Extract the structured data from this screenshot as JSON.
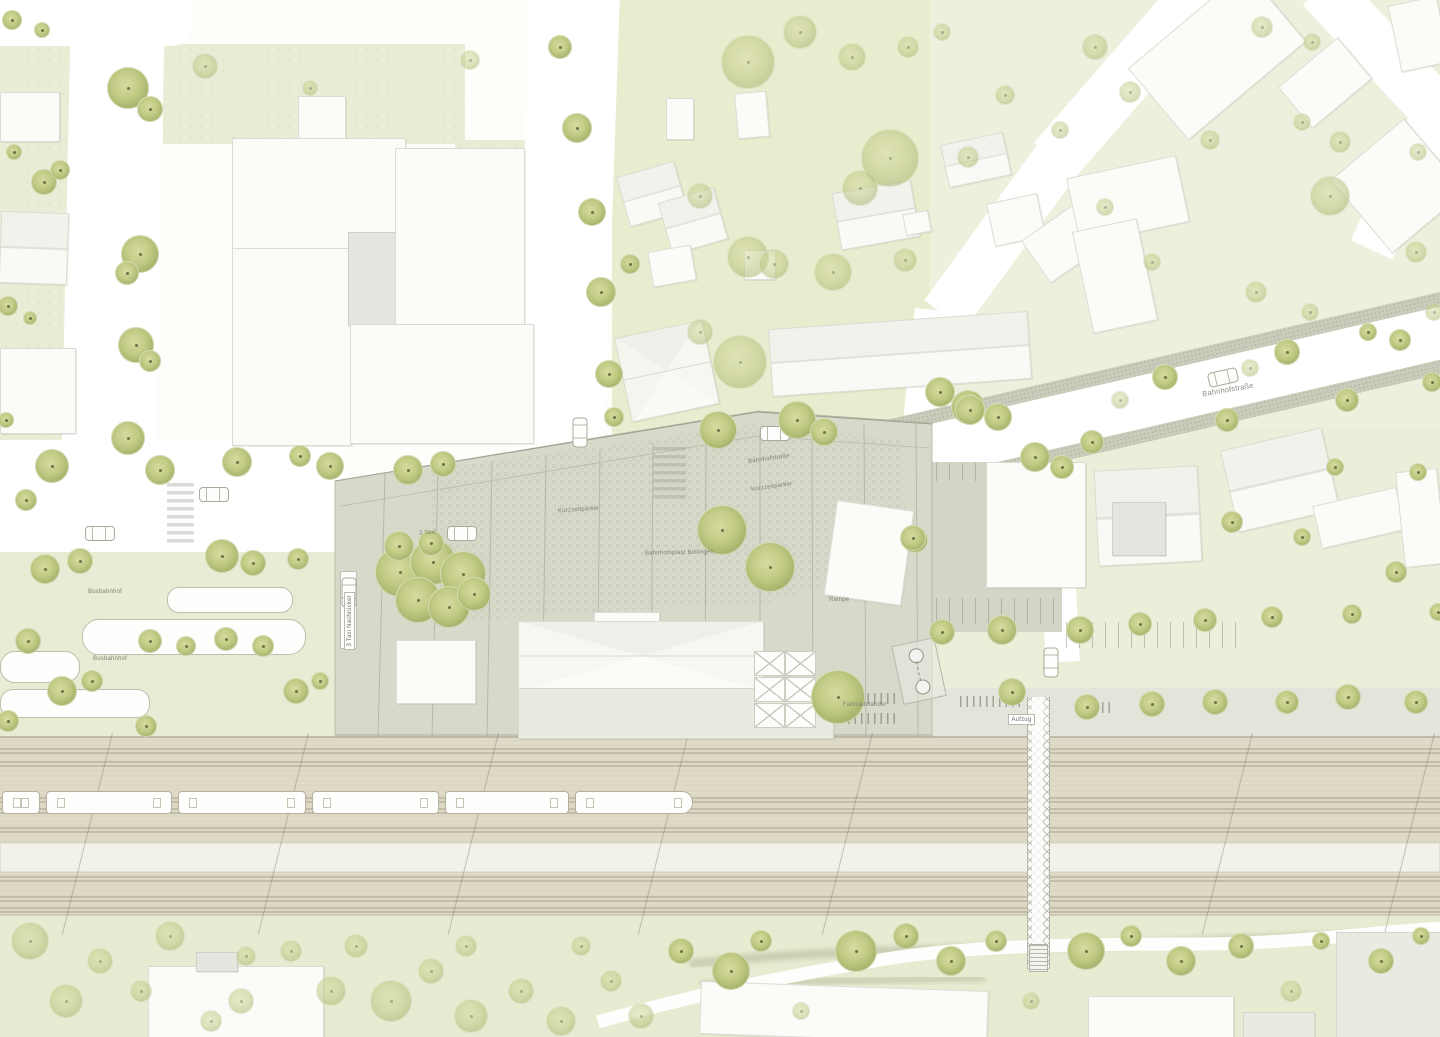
{
  "palette": {
    "road_white": "#ffffff",
    "lawn_green": "#e9edd6",
    "lawn_yellow_green": "#e9ecce",
    "plaza_gray": "#d7d9cb",
    "sidewalk_gray": "#c9ccba",
    "railbed_beige": "#dcd8c3",
    "platform_white": "#f2f2ea",
    "tree_green": "#b5c178",
    "tree_dot": "#4f5c33",
    "building_white": "#fbfbf8",
    "building_outline": "#dcdcd4",
    "label_gray": "#7f8076"
  },
  "labels": [
    {
      "t": "Busbahnhof",
      "x": 88,
      "y": 589
    },
    {
      "t": "Busbahnhof",
      "x": 93,
      "y": 656
    },
    {
      "t": "2 Taxi",
      "x": 419,
      "y": 530,
      "r": -3
    },
    {
      "t": "3 Taxi Nachrücker",
      "x": 344,
      "y": 650,
      "v": 1,
      "box": 1
    },
    {
      "t": "Kurzzeitparker",
      "x": 558,
      "y": 507,
      "r": -4
    },
    {
      "t": "Bahnhofsplatz Bellingen",
      "x": 645,
      "y": 550,
      "r": -1
    },
    {
      "t": "Bahnhofstraße",
      "x": 748,
      "y": 456,
      "r": -8
    },
    {
      "t": "Kurzzeitparker",
      "x": 751,
      "y": 484,
      "r": -8
    },
    {
      "t": "Fahrradständer",
      "x": 843,
      "y": 702
    },
    {
      "t": "Rampe",
      "x": 829,
      "y": 597
    },
    {
      "t": "Aufzug",
      "x": 1008,
      "y": 714,
      "box": 1
    },
    {
      "t": "Bahnhofstraße",
      "x": 1202,
      "y": 386,
      "r": -10,
      "big": 1
    }
  ],
  "features": {
    "trees": [
      [
        128,
        88,
        21
      ],
      [
        150,
        109,
        13
      ],
      [
        44,
        182,
        13
      ],
      [
        60,
        170,
        10
      ],
      [
        140,
        254,
        19
      ],
      [
        127,
        273,
        12
      ],
      [
        136,
        345,
        18
      ],
      [
        150,
        361,
        11
      ],
      [
        128,
        438,
        17
      ],
      [
        52,
        466,
        17
      ],
      [
        160,
        470,
        15
      ],
      [
        237,
        462,
        15
      ],
      [
        300,
        456,
        11
      ],
      [
        12,
        20,
        10
      ],
      [
        42,
        30,
        8
      ],
      [
        14,
        152,
        8
      ],
      [
        8,
        306,
        10
      ],
      [
        30,
        318,
        7
      ],
      [
        6,
        420,
        8
      ],
      [
        26,
        500,
        11
      ],
      [
        205,
        66,
        13,
        1
      ],
      [
        310,
        88,
        8,
        1
      ],
      [
        470,
        60,
        10,
        1
      ],
      [
        560,
        47,
        12
      ],
      [
        577,
        128,
        15
      ],
      [
        592,
        212,
        14
      ],
      [
        601,
        292,
        15
      ],
      [
        609,
        374,
        14
      ],
      [
        614,
        417,
        10
      ],
      [
        630,
        264,
        10
      ],
      [
        748,
        62,
        27,
        1
      ],
      [
        800,
        32,
        17,
        1
      ],
      [
        852,
        57,
        14,
        1
      ],
      [
        890,
        158,
        29,
        1
      ],
      [
        860,
        188,
        18,
        1
      ],
      [
        700,
        196,
        13,
        1
      ],
      [
        748,
        257,
        21,
        1
      ],
      [
        774,
        264,
        15,
        1
      ],
      [
        833,
        272,
        19,
        1
      ],
      [
        700,
        332,
        13,
        1
      ],
      [
        740,
        362,
        27,
        1
      ],
      [
        797,
        420,
        19
      ],
      [
        824,
        432,
        14
      ],
      [
        940,
        392,
        15
      ],
      [
        968,
        407,
        17
      ],
      [
        998,
        417,
        14
      ],
      [
        908,
        47,
        11,
        1
      ],
      [
        942,
        32,
        9,
        1
      ],
      [
        968,
        157,
        11,
        1
      ],
      [
        905,
        260,
        12,
        1
      ],
      [
        1005,
        95,
        10,
        1
      ],
      [
        1095,
        47,
        13,
        1
      ],
      [
        1130,
        92,
        11,
        1
      ],
      [
        1262,
        27,
        11,
        1
      ],
      [
        1312,
        42,
        9,
        1
      ],
      [
        1340,
        142,
        11,
        1
      ],
      [
        1302,
        122,
        9,
        1
      ],
      [
        1418,
        152,
        9,
        1
      ],
      [
        1105,
        207,
        9,
        1
      ],
      [
        1256,
        292,
        11,
        1
      ],
      [
        1310,
        312,
        9,
        1
      ],
      [
        1416,
        252,
        11,
        1
      ],
      [
        1434,
        312,
        9,
        1
      ],
      [
        1330,
        196,
        20,
        1
      ],
      [
        1152,
        262,
        9,
        1
      ],
      [
        1060,
        130,
        9,
        1
      ],
      [
        1210,
        140,
        10,
        1
      ],
      [
        970,
        410,
        15
      ],
      [
        1035,
        457,
        15
      ],
      [
        1092,
        442,
        12
      ],
      [
        1165,
        377,
        13
      ],
      [
        1227,
        420,
        12
      ],
      [
        1287,
        352,
        13
      ],
      [
        1347,
        400,
        12
      ],
      [
        1400,
        340,
        11
      ],
      [
        1368,
        332,
        9
      ],
      [
        1432,
        382,
        10
      ],
      [
        1120,
        400,
        9,
        1
      ],
      [
        1250,
        368,
        9,
        1
      ],
      [
        915,
        540,
        13
      ],
      [
        942,
        632,
        13
      ],
      [
        1002,
        630,
        15
      ],
      [
        1012,
        692,
        14
      ],
      [
        1080,
        630,
        14
      ],
      [
        1087,
        707,
        13
      ],
      [
        1140,
        624,
        12
      ],
      [
        1152,
        704,
        13
      ],
      [
        1205,
        620,
        12
      ],
      [
        1215,
        702,
        13
      ],
      [
        1272,
        617,
        11
      ],
      [
        1287,
        702,
        12
      ],
      [
        1348,
        697,
        13
      ],
      [
        1352,
        614,
        10
      ],
      [
        1416,
        702,
        12
      ],
      [
        1438,
        612,
        9
      ],
      [
        1232,
        522,
        11
      ],
      [
        1302,
        537,
        9
      ],
      [
        1396,
        572,
        11
      ],
      [
        1418,
        472,
        9
      ],
      [
        1335,
        467,
        9
      ],
      [
        1062,
        467,
        12
      ],
      [
        400,
        572,
        25
      ],
      [
        433,
        562,
        23
      ],
      [
        463,
        574,
        23
      ],
      [
        418,
        600,
        23
      ],
      [
        449,
        607,
        21
      ],
      [
        474,
        594,
        17
      ],
      [
        399,
        546,
        15
      ],
      [
        431,
        543,
        13
      ],
      [
        722,
        530,
        25
      ],
      [
        770,
        567,
        25
      ],
      [
        838,
        697,
        27
      ],
      [
        718,
        430,
        19
      ],
      [
        330,
        466,
        14
      ],
      [
        408,
        470,
        15
      ],
      [
        443,
        464,
        13
      ],
      [
        913,
        538,
        13
      ],
      [
        45,
        569,
        15
      ],
      [
        80,
        561,
        13
      ],
      [
        222,
        556,
        17
      ],
      [
        253,
        563,
        13
      ],
      [
        298,
        559,
        11
      ],
      [
        28,
        641,
        13
      ],
      [
        62,
        691,
        15
      ],
      [
        92,
        681,
        11
      ],
      [
        150,
        641,
        12
      ],
      [
        186,
        646,
        10
      ],
      [
        226,
        639,
        12
      ],
      [
        263,
        646,
        11
      ],
      [
        296,
        691,
        13
      ],
      [
        320,
        681,
        9
      ],
      [
        8,
        721,
        11
      ],
      [
        146,
        726,
        11
      ],
      [
        30,
        941,
        19,
        1
      ],
      [
        66,
        1001,
        17,
        1
      ],
      [
        100,
        961,
        13,
        1
      ],
      [
        170,
        936,
        15,
        1
      ],
      [
        241,
        1001,
        13,
        1
      ],
      [
        291,
        951,
        11,
        1
      ],
      [
        331,
        991,
        15,
        1
      ],
      [
        391,
        1001,
        21,
        1
      ],
      [
        431,
        971,
        13,
        1
      ],
      [
        471,
        1016,
        17,
        1
      ],
      [
        521,
        991,
        13,
        1
      ],
      [
        561,
        1021,
        15,
        1
      ],
      [
        611,
        981,
        11,
        1
      ],
      [
        641,
        1016,
        13,
        1
      ],
      [
        681,
        951,
        13
      ],
      [
        731,
        971,
        19
      ],
      [
        761,
        941,
        11
      ],
      [
        801,
        1011,
        9,
        1
      ],
      [
        856,
        951,
        21
      ],
      [
        906,
        936,
        13
      ],
      [
        951,
        961,
        15
      ],
      [
        996,
        941,
        11
      ],
      [
        1031,
        1001,
        9,
        1
      ],
      [
        1086,
        951,
        19
      ],
      [
        1131,
        936,
        11
      ],
      [
        1181,
        961,
        15
      ],
      [
        1241,
        946,
        13
      ],
      [
        1291,
        991,
        11,
        1
      ],
      [
        1321,
        941,
        9
      ],
      [
        1381,
        961,
        13
      ],
      [
        1421,
        936,
        9
      ],
      [
        211,
        1021,
        11,
        1
      ],
      [
        141,
        991,
        11,
        1
      ],
      [
        581,
        946,
        10,
        1
      ],
      [
        466,
        946,
        11,
        1
      ],
      [
        246,
        956,
        10,
        1
      ],
      [
        356,
        946,
        12,
        1
      ]
    ],
    "buildings": [
      {
        "x": 0,
        "y": 92,
        "w": 58,
        "h": 48,
        "k": "w"
      },
      {
        "x": 0,
        "y": 212,
        "w": 66,
        "h": 70,
        "r": 2,
        "k": "rh"
      },
      {
        "x": 0,
        "y": 348,
        "w": 74,
        "h": 84,
        "k": "w"
      },
      {
        "x": 298,
        "y": 96,
        "w": 46,
        "h": 44,
        "k": "w"
      },
      {
        "x": 232,
        "y": 138,
        "w": 172,
        "h": 112,
        "k": "w"
      },
      {
        "x": 232,
        "y": 248,
        "w": 118,
        "h": 196,
        "k": "w"
      },
      {
        "x": 348,
        "y": 232,
        "w": 112,
        "h": 92,
        "k": "g"
      },
      {
        "x": 395,
        "y": 148,
        "w": 128,
        "h": 186,
        "k": "w"
      },
      {
        "x": 350,
        "y": 324,
        "w": 182,
        "h": 118,
        "k": "w"
      },
      {
        "x": 666,
        "y": 98,
        "w": 26,
        "h": 40,
        "k": "w"
      },
      {
        "x": 736,
        "y": 92,
        "w": 30,
        "h": 44,
        "r": -5,
        "k": "w"
      },
      {
        "x": 622,
        "y": 168,
        "w": 58,
        "h": 50,
        "r": -16,
        "k": "rh"
      },
      {
        "x": 664,
        "y": 194,
        "w": 56,
        "h": 52,
        "r": -16,
        "k": "rh"
      },
      {
        "x": 650,
        "y": 248,
        "w": 42,
        "h": 34,
        "r": -10,
        "k": "w"
      },
      {
        "x": 744,
        "y": 250,
        "w": 30,
        "h": 28,
        "k": "w"
      },
      {
        "x": 622,
        "y": 328,
        "w": 88,
        "h": 84,
        "r": -12,
        "k": "hip"
      },
      {
        "x": 836,
        "y": 186,
        "w": 78,
        "h": 56,
        "r": -10,
        "k": "rh"
      },
      {
        "x": 904,
        "y": 212,
        "w": 24,
        "h": 20,
        "r": -10,
        "k": "w"
      },
      {
        "x": 770,
        "y": 320,
        "w": 258,
        "h": 66,
        "r": -4,
        "k": "rh"
      },
      {
        "x": 944,
        "y": 138,
        "w": 62,
        "h": 42,
        "r": -12,
        "k": "rh"
      },
      {
        "x": 990,
        "y": 198,
        "w": 50,
        "h": 42,
        "r": -12,
        "k": "w"
      },
      {
        "x": 1030,
        "y": 218,
        "w": 62,
        "h": 50,
        "r": -35,
        "k": "w"
      },
      {
        "x": 1072,
        "y": 166,
        "w": 110,
        "h": 66,
        "r": -12,
        "k": "w"
      },
      {
        "x": 1082,
        "y": 224,
        "w": 64,
        "h": 102,
        "r": -12,
        "k": "w"
      },
      {
        "x": 1140,
        "y": 8,
        "w": 152,
        "h": 92,
        "r": -40,
        "k": "w"
      },
      {
        "x": 1286,
        "y": 56,
        "w": 76,
        "h": 52,
        "r": -40,
        "k": "w"
      },
      {
        "x": 1394,
        "y": 0,
        "w": 48,
        "h": 66,
        "r": -12,
        "k": "w"
      },
      {
        "x": 1350,
        "y": 138,
        "w": 94,
        "h": 94,
        "r": -40,
        "k": "w"
      },
      {
        "x": 986,
        "y": 462,
        "w": 98,
        "h": 124,
        "k": "w"
      },
      {
        "x": 1096,
        "y": 468,
        "w": 102,
        "h": 94,
        "r": -3,
        "k": "rh"
      },
      {
        "x": 1112,
        "y": 502,
        "w": 52,
        "h": 52,
        "k": "g"
      },
      {
        "x": 1228,
        "y": 438,
        "w": 102,
        "h": 82,
        "r": -13,
        "k": "rh"
      },
      {
        "x": 1316,
        "y": 496,
        "w": 84,
        "h": 42,
        "r": -13,
        "k": "w"
      },
      {
        "x": 1400,
        "y": 470,
        "w": 40,
        "h": 94,
        "r": -6,
        "k": "w"
      },
      {
        "x": 830,
        "y": 505,
        "w": 76,
        "h": 94,
        "r": 8,
        "k": "w"
      },
      {
        "x": 594,
        "y": 612,
        "w": 64,
        "h": 13,
        "k": "w"
      },
      {
        "x": 518,
        "y": 621,
        "w": 244,
        "h": 68,
        "k": "hipx"
      },
      {
        "x": 396,
        "y": 640,
        "w": 78,
        "h": 62,
        "k": "w"
      },
      {
        "x": 518,
        "y": 688,
        "w": 314,
        "h": 49,
        "k": "p"
      },
      {
        "x": 148,
        "y": 966,
        "w": 174,
        "h": 71,
        "k": "w"
      },
      {
        "x": 196,
        "y": 952,
        "w": 40,
        "h": 18,
        "k": "g"
      },
      {
        "x": 700,
        "y": 986,
        "w": 286,
        "h": 51,
        "r": 2,
        "k": "w"
      },
      {
        "x": 1088,
        "y": 996,
        "w": 144,
        "h": 41,
        "k": "w"
      },
      {
        "x": 1336,
        "y": 932,
        "w": 104,
        "h": 105,
        "k": "p"
      },
      {
        "x": 1243,
        "y": 1012,
        "w": 70,
        "h": 25,
        "k": "p"
      }
    ],
    "cars": [
      {
        "x": 85,
        "y": 526,
        "r": 0
      },
      {
        "x": 199,
        "y": 487,
        "r": 0
      },
      {
        "x": 565,
        "y": 425,
        "r": 90
      },
      {
        "x": 760,
        "y": 426,
        "r": 0
      },
      {
        "x": 447,
        "y": 526,
        "r": 0
      },
      {
        "x": 1036,
        "y": 655,
        "r": 90
      },
      {
        "x": 1208,
        "y": 370,
        "r": -13
      },
      {
        "x": 334,
        "y": 585,
        "r": 90
      }
    ],
    "train": {
      "y": 791,
      "h": 21,
      "cars": [
        {
          "x": 2,
          "w": 36
        },
        {
          "x": 46,
          "w": 124
        },
        {
          "x": 178,
          "w": 126
        },
        {
          "x": 312,
          "w": 125
        },
        {
          "x": 445,
          "w": 122
        },
        {
          "x": 575,
          "w": 116,
          "nose": 1
        }
      ]
    },
    "bus_platforms": [
      {
        "x": 167,
        "y": 587,
        "w": 124,
        "h": 24,
        "rad": 12
      },
      {
        "x": 82,
        "y": 619,
        "w": 222,
        "h": 34,
        "rad": 17
      },
      {
        "x": 0,
        "y": 651,
        "w": 78,
        "h": 30,
        "rad": 15
      },
      {
        "x": 0,
        "y": 689,
        "w": 148,
        "h": 27,
        "rad": 13
      },
      {
        "x": 340,
        "y": 571,
        "w": 15,
        "h": 76,
        "rad": 2
      }
    ],
    "bike_racks": [
      {
        "x": 848,
        "y": 693,
        "w": 48
      },
      {
        "x": 848,
        "y": 713,
        "w": 48
      },
      {
        "x": 960,
        "y": 696,
        "w": 62
      },
      {
        "x": 1076,
        "y": 702,
        "w": 38
      }
    ],
    "parking_rows": [
      {
        "x": 936,
        "y": 463,
        "w": 122,
        "h": 18
      },
      {
        "x": 936,
        "y": 598,
        "w": 122,
        "h": 26
      },
      {
        "x": 1066,
        "y": 622,
        "w": 182,
        "h": 26
      }
    ],
    "crosswalks": [
      {
        "x": 167,
        "y": 483,
        "w": 27,
        "h": 60
      },
      {
        "x": 653,
        "y": 447,
        "w": 33,
        "h": 54
      }
    ],
    "masts": [
      112,
      308,
      498,
      688,
      872,
      1252,
      1434
    ],
    "canopy_grid": {
      "x": 754,
      "y": 651,
      "cols": 2,
      "rows": 3,
      "cw": 31,
      "ch": 26
    },
    "ramp_marker": {
      "x": 897,
      "y": 641,
      "w": 42,
      "h": 58,
      "r": -12
    }
  }
}
